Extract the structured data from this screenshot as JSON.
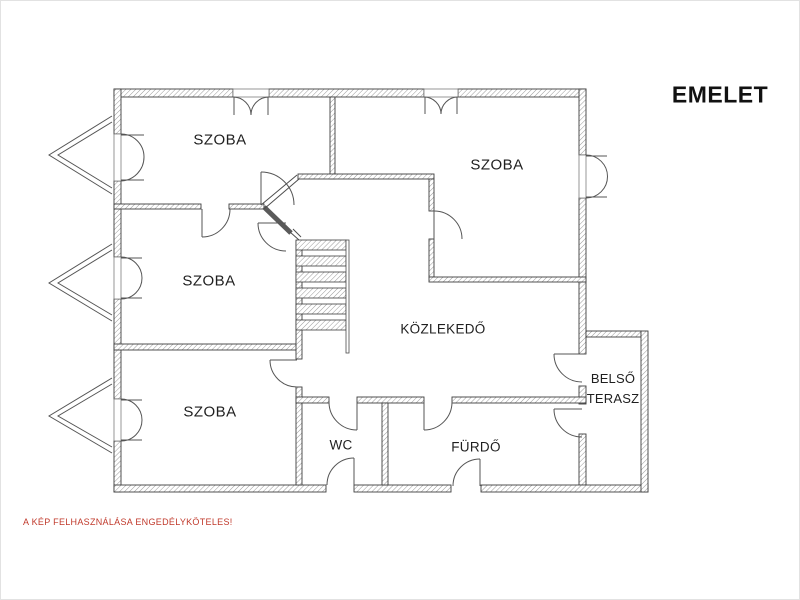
{
  "floor_plan": {
    "floor_label": "EMELET",
    "rooms": [
      {
        "id": "szoba-top-left",
        "label": "SZOBA"
      },
      {
        "id": "szoba-top-right",
        "label": "SZOBA"
      },
      {
        "id": "szoba-middle-left",
        "label": "SZOBA"
      },
      {
        "id": "szoba-bottom-left",
        "label": "SZOBA"
      },
      {
        "id": "kozlekedo",
        "label": "KÖZLEKEDŐ"
      },
      {
        "id": "wc",
        "label": "WC"
      },
      {
        "id": "furdo",
        "label": "FÜRDŐ"
      },
      {
        "id": "belso-terasz",
        "label": "BELSŐ TERASZ",
        "label_line1": "BELSŐ",
        "label_line2": "TERASZ"
      }
    ],
    "features": {
      "stairs_treads": 6,
      "bay_windows_left": 3
    }
  },
  "notice": {
    "text": "A KÉP FELHASZNÁLÁSA ENGEDÉLYKÖTELES!",
    "color": "#c0392b"
  },
  "colors": {
    "background": "#ffffff",
    "wall_outline": "#3d3d3d",
    "wall_hatch": "#9a9a9a",
    "thin_line": "#4c4c4c",
    "label_text": "#1f1f1f",
    "title_text": "#111111"
  }
}
